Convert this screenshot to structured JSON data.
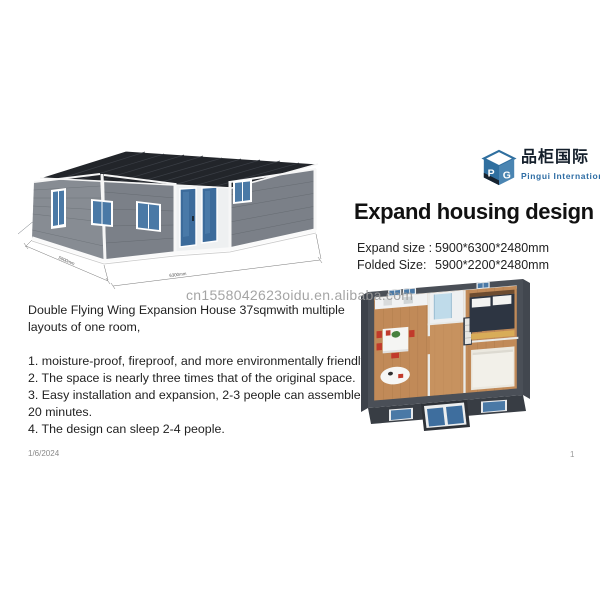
{
  "logo": {
    "monogram_p": "P",
    "monogram_g": "G",
    "name_zh": "品柜国际",
    "name_en": "Pingui International"
  },
  "header": {
    "title": "Expand housing design"
  },
  "specs": {
    "expand_label": "Expand size :",
    "expand_value": "5900*6300*2480mm",
    "folded_label": "Folded Size:",
    "folded_value": "5900*2200*2480mm"
  },
  "watermark": "cn1558042623oidu.en.alibaba.com",
  "description": {
    "intro": "Double Flying Wing Expansion House 37sqmwith multiple layouts of one room,",
    "items": [
      "1. moisture-proof, fireproof, and more environmentally friendly.",
      "2. The space is nearly three times that of the original space.",
      "3. Easy installation and expansion, 2-3 people can assemble in 20 minutes.",
      "4. The design can sleep 2-4 people."
    ]
  },
  "house_drawing": {
    "dim_left": "5900mm",
    "dim_right": "6300mm"
  },
  "footer": {
    "date": "1/6/2024",
    "page": "1"
  },
  "colors": {
    "accent_blue": "#2e6da4",
    "glass_blue": "#3e6e9e",
    "wall_gray": "#7b8088",
    "roof_dark": "#22252a",
    "wood": "#c18a58",
    "watermark_gray": "#9b9b9b"
  }
}
